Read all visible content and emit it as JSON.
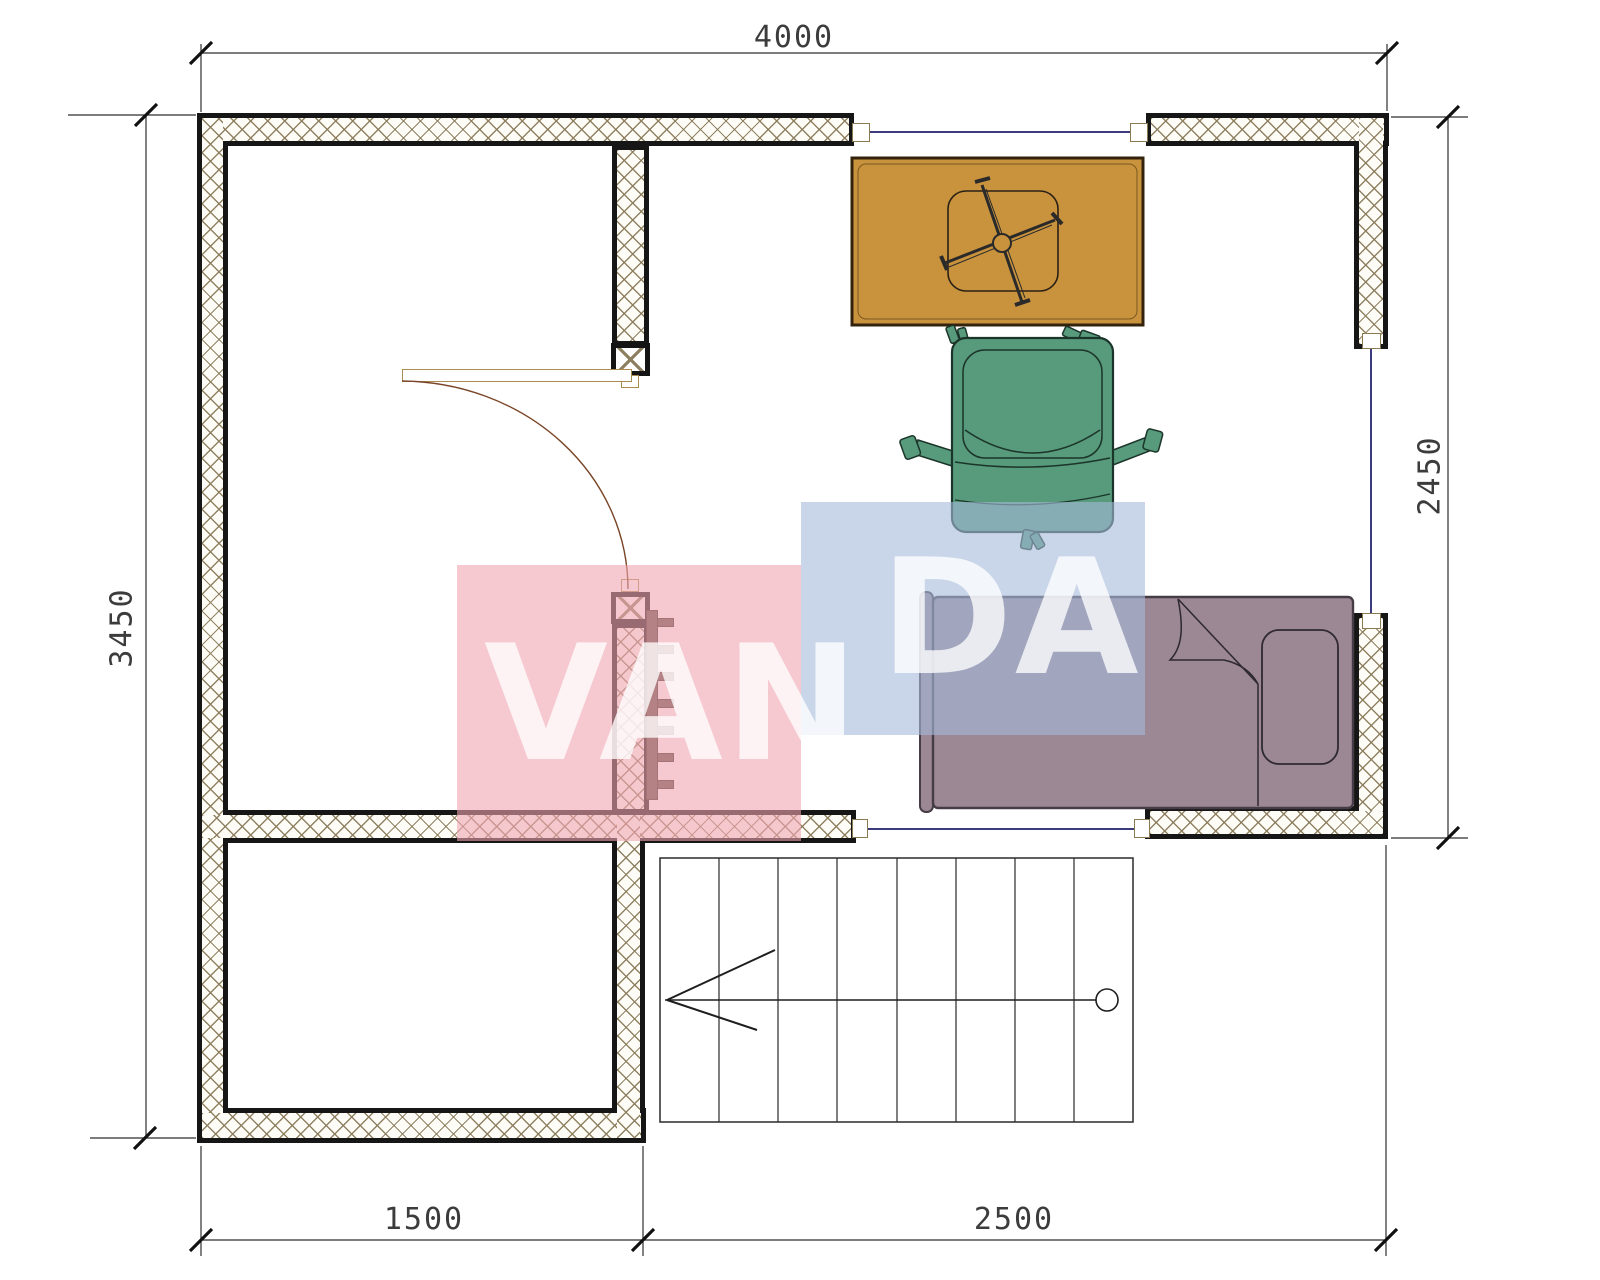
{
  "title": "floor-plan",
  "dimensions": {
    "top": "4000",
    "left": "3450",
    "right": "2450",
    "bottom_left": "1500",
    "bottom_right": "2500"
  },
  "watermark": {
    "text": "VANDA",
    "left_part": "VAN",
    "right_part": "DA",
    "pink_color": "#f0a5b1",
    "blue_color": "#a5bbda",
    "letter_color": "#ffffff"
  },
  "colors": {
    "wall_line": "#161616",
    "wall_hatch": "#8b7c5c",
    "window_line": "#3b3b7e",
    "desk": "#c9933d",
    "chair": "#579a7c",
    "bed": "#9c8795",
    "radiator": "#5b4f42",
    "dimension_line": "#2f2f2f",
    "door_arc": "#7a4526"
  }
}
